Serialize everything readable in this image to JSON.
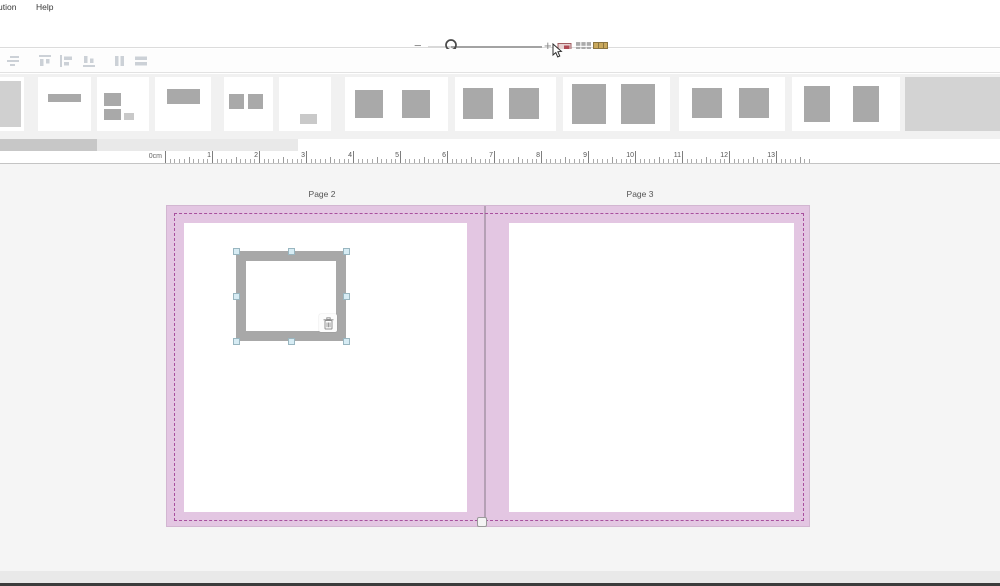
{
  "menu": {
    "items": [
      "ution",
      "Help"
    ]
  },
  "zoom_toolbar": {
    "zoom_out_label": "−",
    "zoom_in_label": "+",
    "slider_handle_icon": "magnifier-icon",
    "right_icons": [
      "image-pointer-icon",
      "grid-view-icon",
      "pages-table-icon"
    ]
  },
  "alignment_toolbar": {
    "icons": [
      "align-text-icon",
      "align-top-icon",
      "align-left-icon",
      "align-bottom-icon",
      "distribute-columns-icon",
      "distribute-rows-icon"
    ]
  },
  "template_strip": {
    "templates": [
      {
        "name": "full-page-image"
      },
      {
        "name": "title-text-bar"
      },
      {
        "name": "two-images-with-caption"
      },
      {
        "name": "single-landscape-image-top"
      },
      {
        "name": "two-small-squares"
      },
      {
        "name": "small-caption-bottom"
      },
      {
        "name": "spread-two-squares"
      },
      {
        "name": "spread-two-squares-wide"
      },
      {
        "name": "spread-two-squares-large"
      },
      {
        "name": "spread-two-squares-medium"
      },
      {
        "name": "spread-two-portrait-images"
      },
      {
        "name": "plain-gray-spread"
      }
    ]
  },
  "ruler": {
    "unit_label": "0cm",
    "major_labels": [
      "1",
      "2",
      "3",
      "4",
      "5",
      "6",
      "7",
      "8",
      "9",
      "10",
      "11",
      "12",
      "13"
    ],
    "minor_step_px": 4.7,
    "length_px": 646
  },
  "canvas": {
    "pages": [
      {
        "label": "Page 2"
      },
      {
        "label": "Page 3"
      }
    ],
    "selection": {
      "delete_icon": "trash-icon",
      "handle_count": 8
    }
  },
  "colors": {
    "page_fill": "#e3c6e2",
    "bleed_dash": "#a8509e",
    "frame_gray": "#a8a8a8",
    "selection_handle_fill": "#d7ecf4",
    "canvas_background": "#f5f5f5"
  }
}
